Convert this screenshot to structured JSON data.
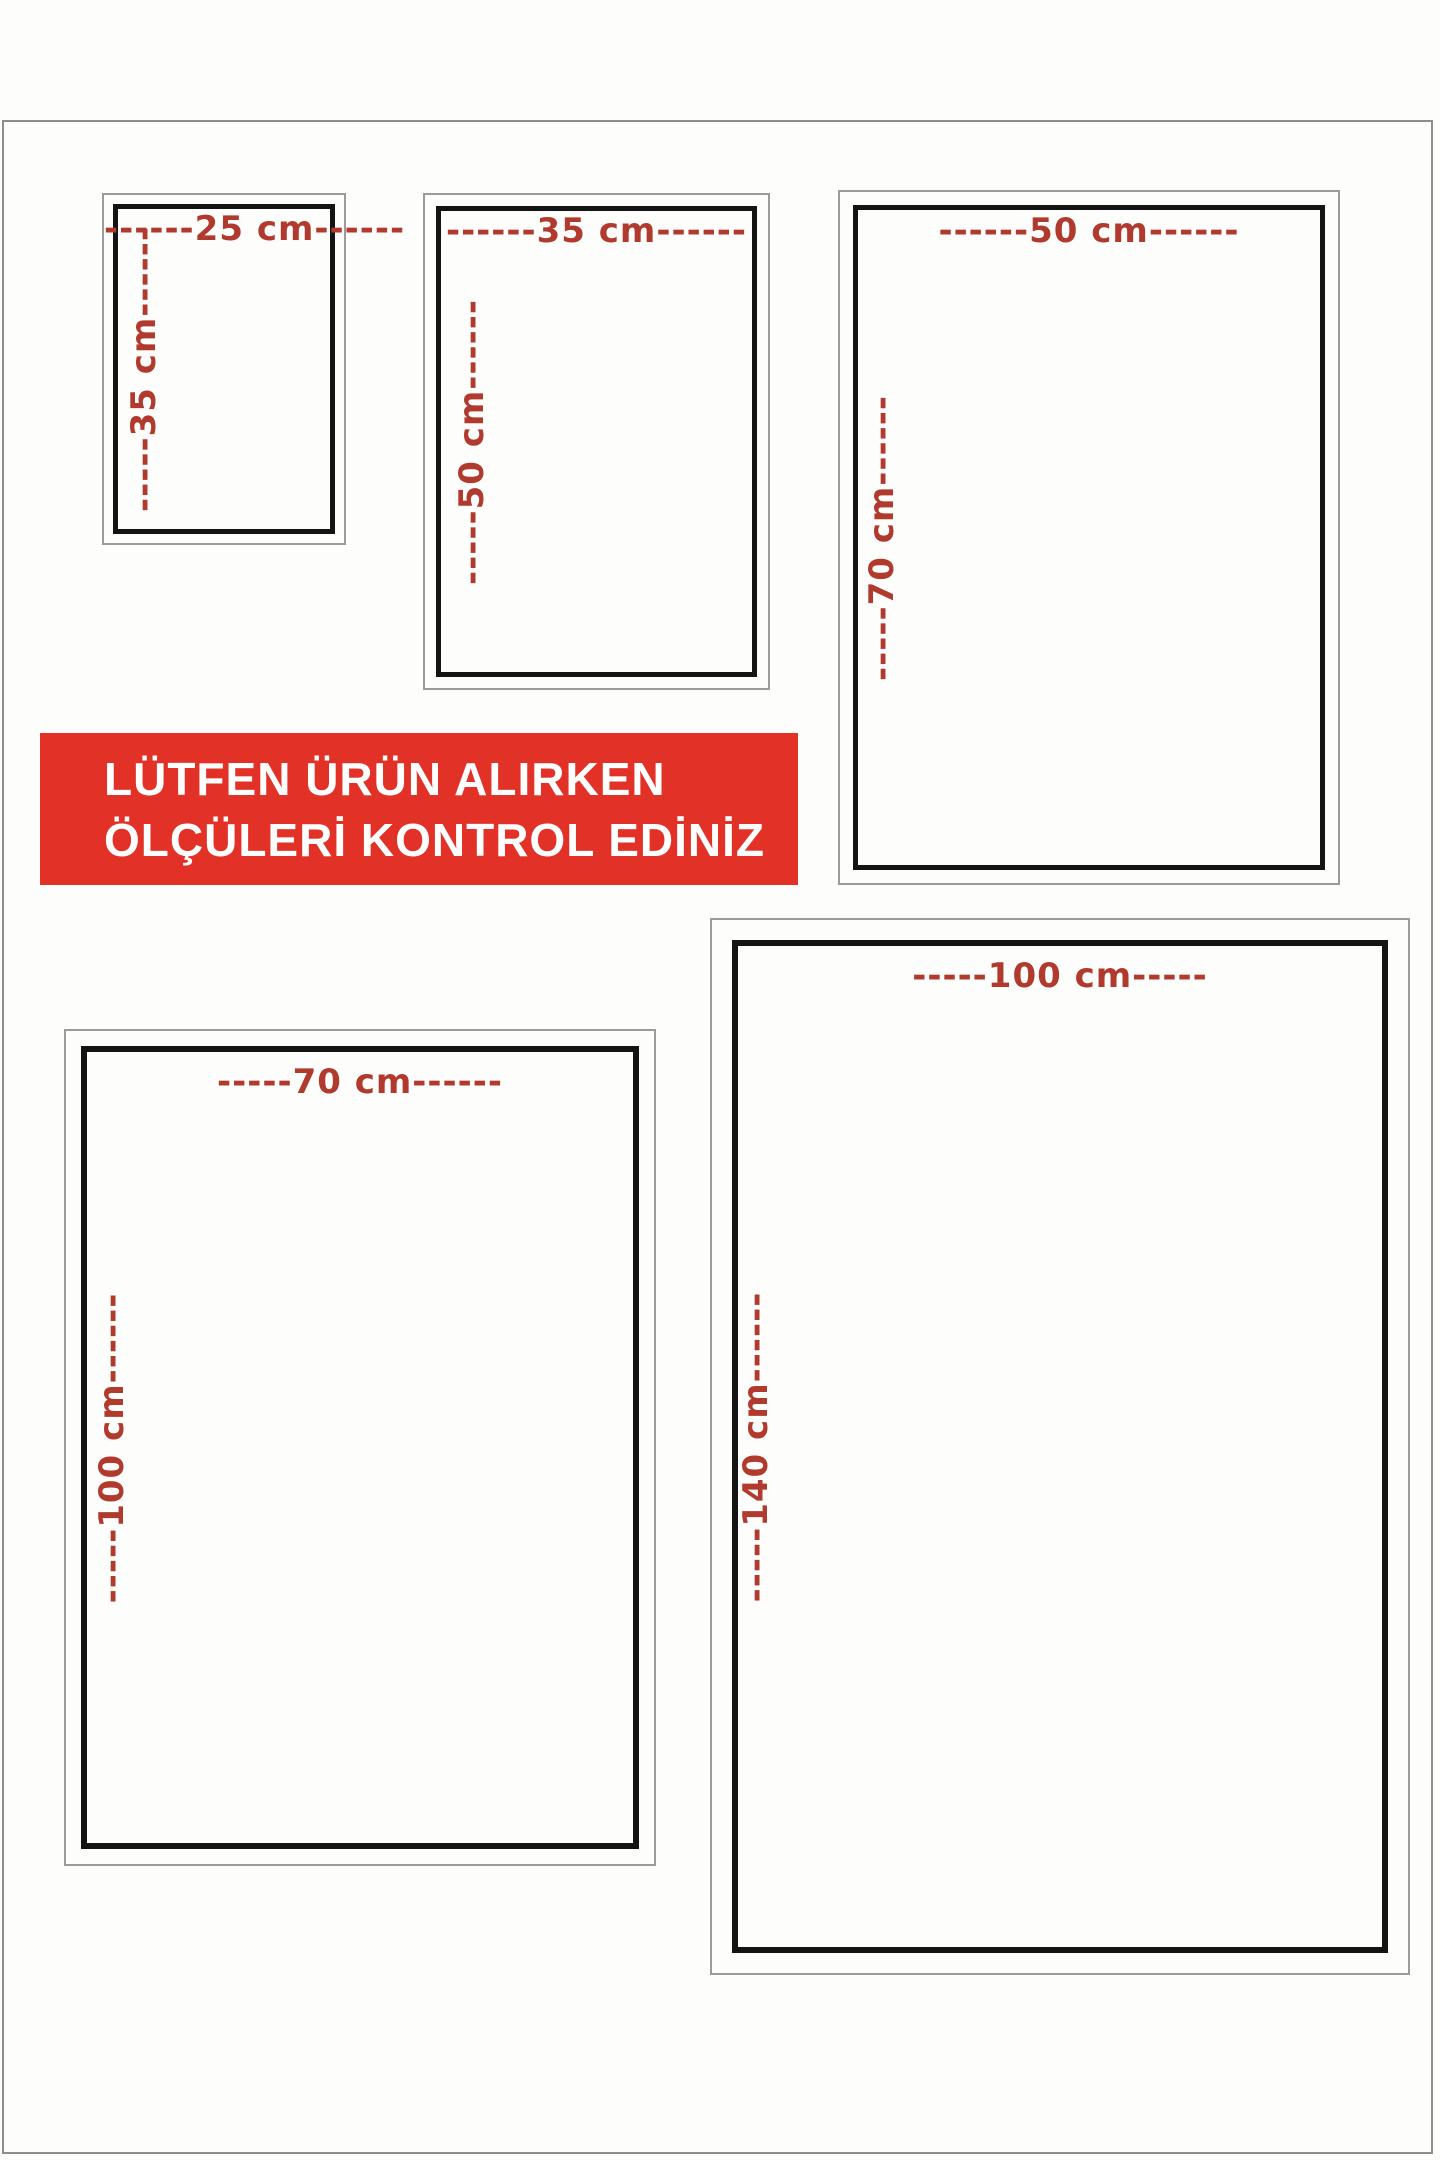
{
  "page": {
    "background_color": "#fdfdfc",
    "accent_text_color": "#b13a2e",
    "box_inner_border_color": "#141414",
    "box_outer_border_color": "#9b9b9b"
  },
  "banner": {
    "line1": "LÜTFEN ÜRÜN ALIRKEN",
    "line2": "ÖLÇÜLERİ KONTROL EDİNİZ",
    "background_color": "#e23227",
    "text_color": "#ffffff"
  },
  "size_boxes": [
    {
      "name": "25x35",
      "width_cm": 25,
      "height_cm": 35,
      "width_label": "------25 cm------",
      "height_label": "-----35 cm------"
    },
    {
      "name": "35x50",
      "width_cm": 35,
      "height_cm": 50,
      "width_label": "------35 cm------",
      "height_label": "-----50 cm------"
    },
    {
      "name": "50x70",
      "width_cm": 50,
      "height_cm": 70,
      "width_label": "------50 cm------",
      "height_label": "-----70 cm------"
    },
    {
      "name": "70x100",
      "width_cm": 70,
      "height_cm": 100,
      "width_label": "-----70 cm------",
      "height_label": "-----100 cm------"
    },
    {
      "name": "100x140",
      "width_cm": 100,
      "height_cm": 140,
      "width_label": "-----100 cm-----",
      "height_label": "-----140 cm------"
    }
  ]
}
